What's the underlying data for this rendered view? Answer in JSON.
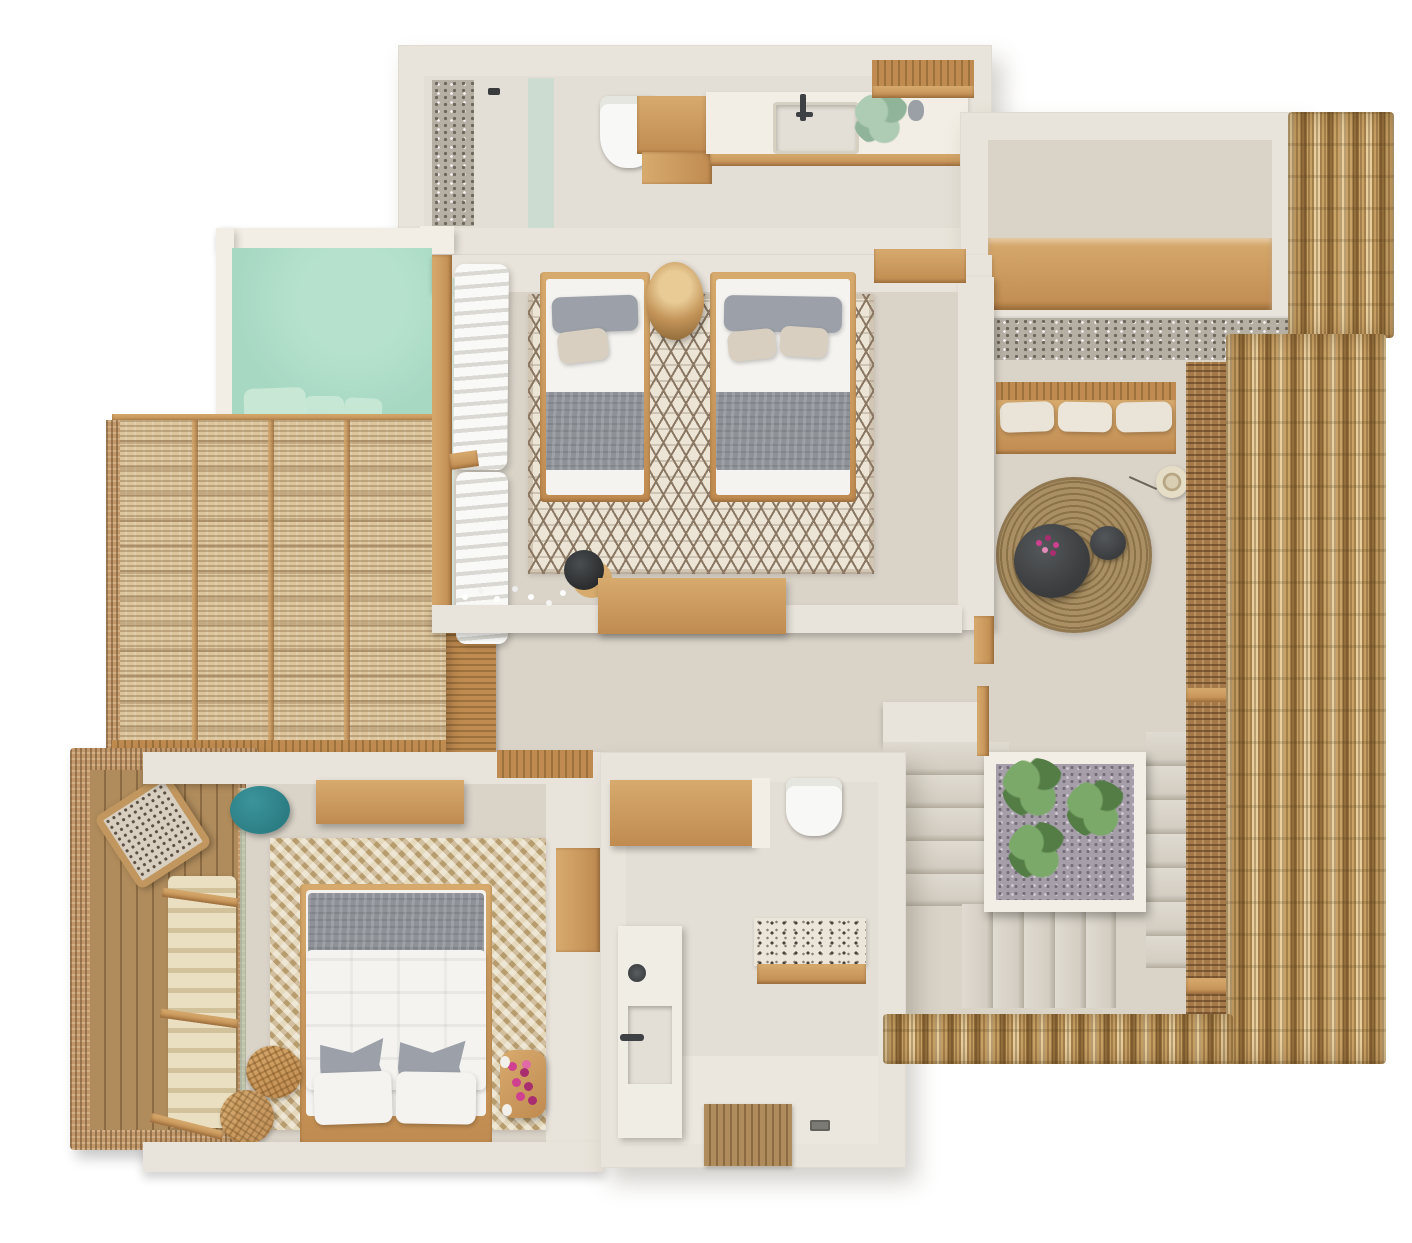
{
  "meta": {
    "title": "Top-down 3D rendered villa floor plan",
    "canvas": {
      "width": 1412,
      "height": 1243
    },
    "rooms": [
      "bathroom-top",
      "entry-hall",
      "living-lounge",
      "stair-hall",
      "twin-bedroom",
      "plunge-pool",
      "pergola-lounge",
      "corridor",
      "master-bedroom",
      "master-deck",
      "bathroom-master"
    ]
  },
  "palette": {
    "pageBg": "#ffffff",
    "wall": "#e9e4db",
    "wallBright": "#f2eee5",
    "floor": "#d9d3c8",
    "floorLight": "#e1dcd2",
    "floorBath": "#e4dfd6",
    "poolWater": "#a6d8c2",
    "poolStep": "#c9e8d6",
    "wood": "#c08b50",
    "woodLight": "#d7aa6d",
    "woodDark": "#9c713c",
    "deckBoard": "#b08c5c",
    "deckGap": "#8c6b42",
    "rattan": "#ddc69e",
    "rattanDark": "#c3996b",
    "thatch": "#c9a265",
    "thatchLight": "#e9d09e",
    "thatchDark": "#95703d",
    "screen": "#a67a48",
    "pebble": "#b5afa4",
    "pebbleDot": "#6e675c",
    "jute": "#a98f63",
    "juteDark": "#8a7147",
    "charcoal": "#393b3d",
    "teal": "#2b7d83",
    "tealLight": "#3c949b",
    "gravel": "#a69faa",
    "gravelDot": "#756d79",
    "leaf": "#79aa66",
    "leafDark": "#527e44",
    "leafPale": "#aecbb4",
    "leafPaleDark": "#8fb49a",
    "blanketGray": "#8e9298",
    "pillowGray": "#9ca0a8",
    "pillowBeige": "#d8cfc0",
    "bedWhite": "#f4f3f0",
    "shadeCream": "#eadfc1",
    "shadeCreamDark": "#d2c29c",
    "curtainWhite": "#f9f9f7",
    "curtainShadow": "#d9d8d2",
    "rugBase": "#ece5d6",
    "rugMotif": "#8b7863",
    "herringLight": "#e6dabe",
    "herringDark": "#b79c6e",
    "terrazzo": "#ebe5da",
    "terrazzoDot": "#4a443c",
    "pink": "#cf4190",
    "pinkDark": "#a82e6f",
    "glass": "#bfdacd",
    "porcelain": "#f8f8f6",
    "metal": "#3f4245"
  }
}
